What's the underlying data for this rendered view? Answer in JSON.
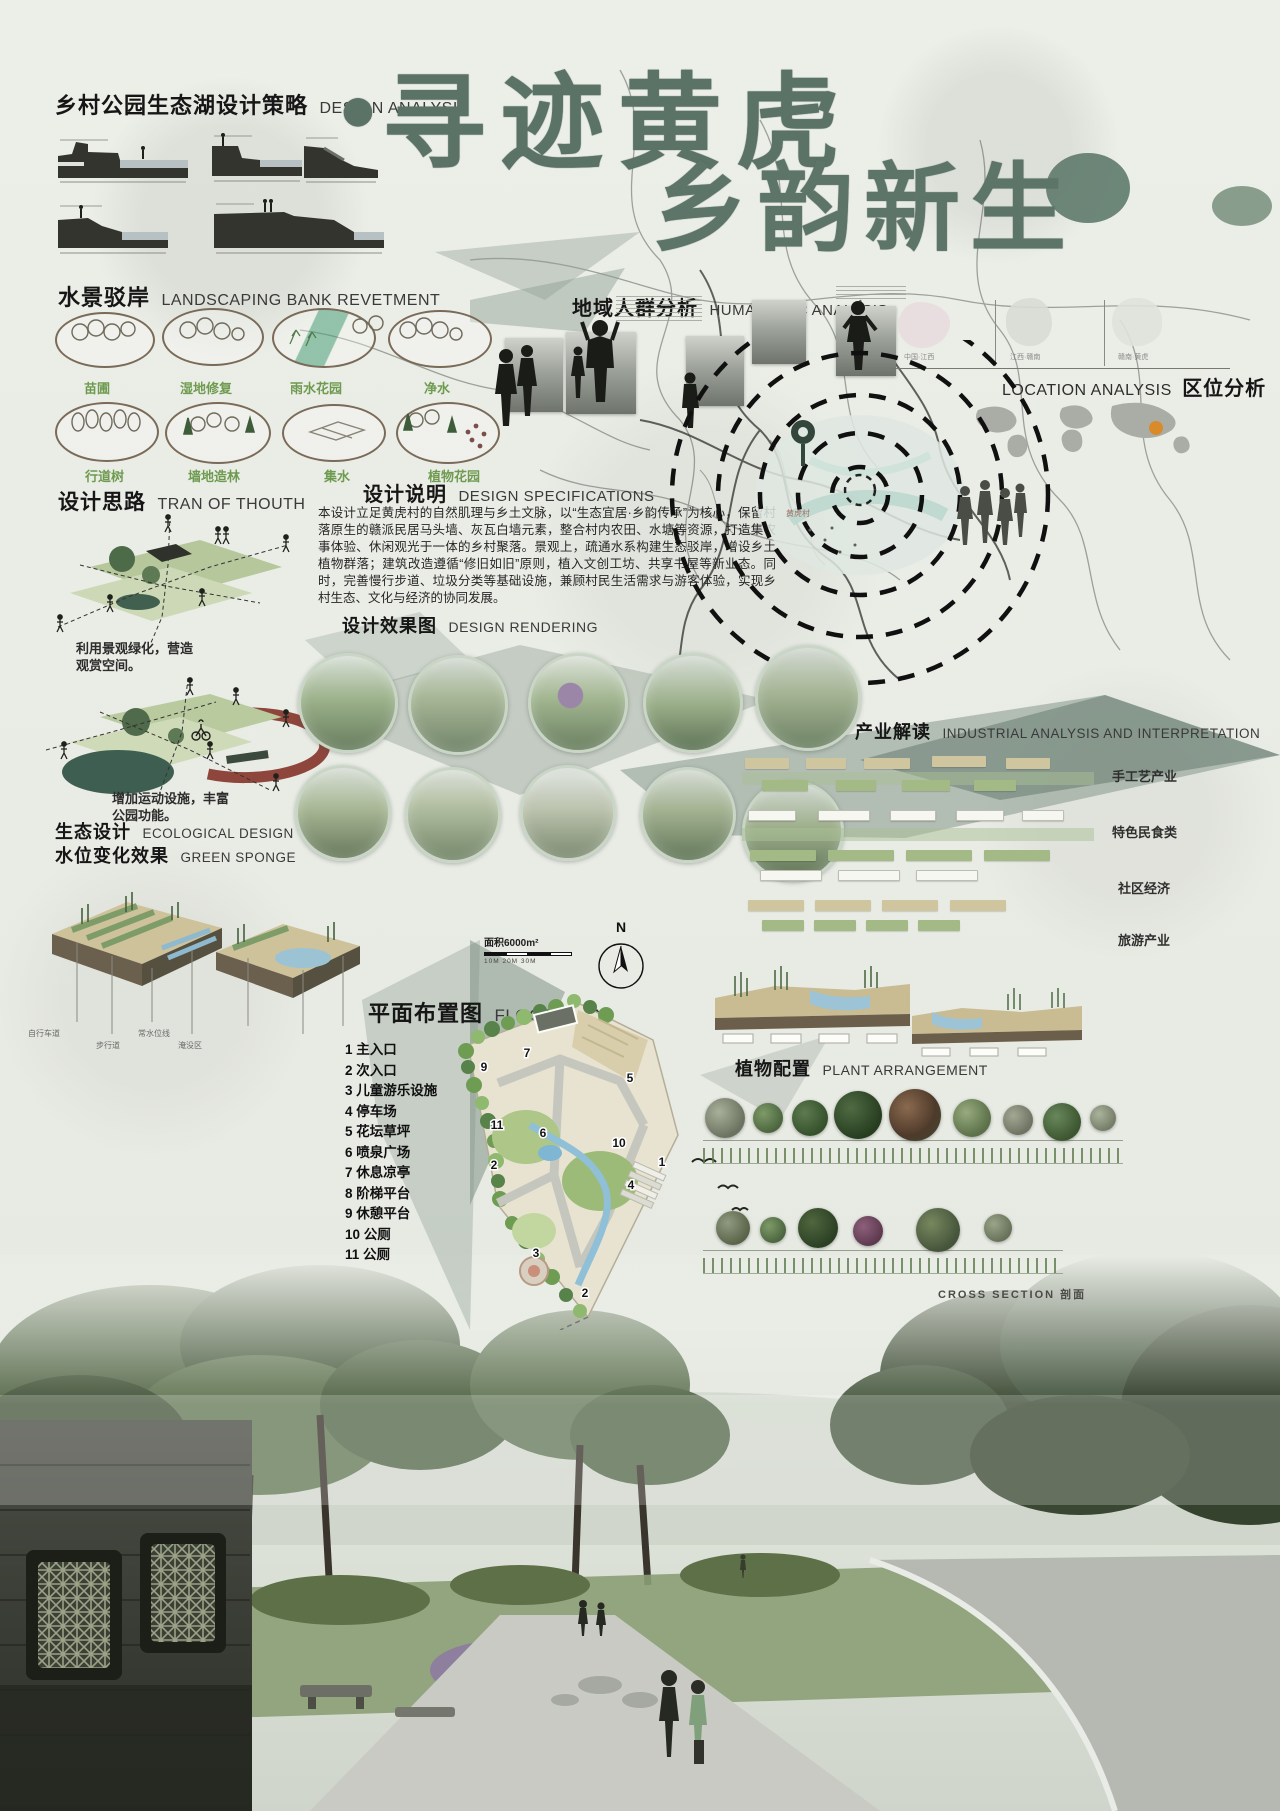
{
  "analysis": {
    "zh": "乡村公园生态湖设计策略",
    "en": "DESIGN ANALYSIS"
  },
  "title": {
    "dot": "●",
    "line1": "寻迹黄虎",
    "line2": "乡韵新生"
  },
  "revetment": {
    "zh": "水景驳岸",
    "en": "LANDSCAPING BANK REVETMENT",
    "items": [
      "苗圃",
      "湿地修复",
      "雨水花园",
      "净水",
      "行道树",
      "墙地造林",
      "集水",
      "植物花园"
    ]
  },
  "thought": {
    "zh": "设计思路",
    "en": "TRAN OF THOUTH",
    "caption1": "利用景观绿化，营造",
    "caption1b": "观赏空间。",
    "caption2": "增加运动设施，丰富",
    "caption2b": "公园功能。"
  },
  "specs": {
    "zh": "设计说明",
    "en": "DESIGN SPECIFICATIONS",
    "body": "本设计立足黄虎村的自然肌理与乡土文脉，以“生态宜居·乡韵传承”为核心，保留村落原生的赣派民居马头墙、灰瓦白墙元素，整合村内农田、水塘等资源，打造集农事体验、休闲观光于一体的乡村聚落。景观上，疏通水系构建生态驳岸，增设乡土植物群落；建筑改造遵循“修旧如旧”原则，植入文创工坊、共享书屋等新业态。同时，完善慢行步道、垃圾分类等基础设施，兼顾村民生活需求与游客体验，实现乡村生态、文化与经济的协同发展。"
  },
  "humanistic": {
    "zh": "地域人群分析",
    "en": "HUMANISTIC ANALYSIS"
  },
  "location": {
    "en": "LOCATION ANALYSIS",
    "zh": "区位分析",
    "maps": [
      "中国·江西",
      "江西·赣南",
      "赣南·黄虎"
    ],
    "site": "黄虎村"
  },
  "rendering": {
    "zh": "设计效果图",
    "en": "DESIGN RENDERING"
  },
  "industry": {
    "zh": "产业解读",
    "en": "INDUSTRIAL ANALYSIS AND INTERPRETATION",
    "labels": [
      "手工艺产业",
      "特色民食类",
      "社区经济",
      "旅游产业"
    ]
  },
  "ecology": {
    "zh1": "生态设计",
    "en1": "ECOLOGICAL DESIGN",
    "zh2": "水位变化效果",
    "en2": "GREEN SPONGE",
    "tags": [
      "自行车道",
      "步行道",
      "常水位线",
      "淹没区"
    ]
  },
  "floorplan": {
    "zh": "平面布置图",
    "en": "FLOOR PLAN",
    "area": "面积6000m²",
    "north": "N",
    "scale": "10M   20M   30M",
    "legend": [
      "1 主入口",
      "2 次入口",
      "3 儿童游乐设施",
      "4 停车场",
      "5 花坛草坪",
      "6 喷泉广场",
      "7 休息凉亭",
      "8 阶梯平台",
      "9 休憩平台",
      "10 公厕",
      "11 公厕"
    ],
    "callouts": [
      "9",
      "7",
      "5",
      "11",
      "6",
      "10",
      "1",
      "2",
      "4",
      "3",
      "2"
    ]
  },
  "plants": {
    "zh": "植物配置",
    "en": "PLANT ARRANGEMENT",
    "cross": "CROSS SECTION 剖面"
  }
}
